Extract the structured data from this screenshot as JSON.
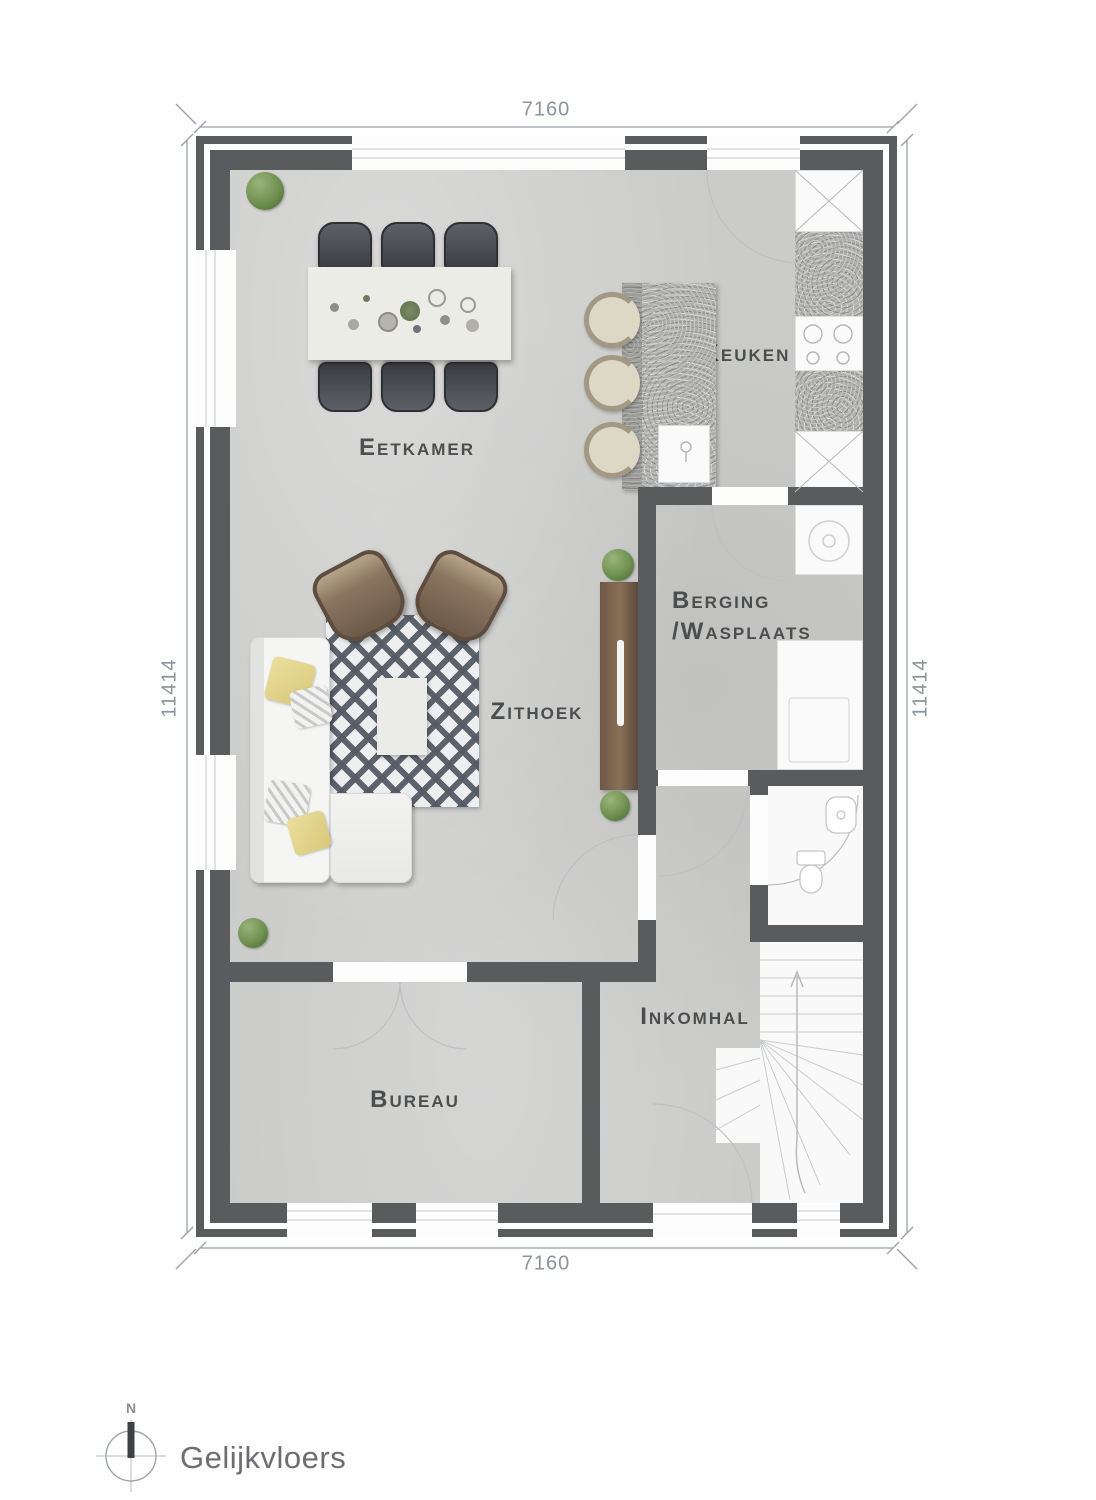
{
  "floor": {
    "title": "Gelijkvloers",
    "compass_north": "N"
  },
  "dimensions": {
    "top": "7160",
    "bottom": "7160",
    "left": "11414",
    "right": "11414"
  },
  "rooms": {
    "eetkamer": "Eetkamer",
    "keuken": "Keuken",
    "berging_line1": "Berging",
    "berging_line2": "/Wasplaats",
    "zithoek": "Zithoek",
    "inkomhal": "Inkomhal",
    "bureau": "Bureau"
  },
  "colors": {
    "wall": "#5a5b5d",
    "floor": "#cbcbca",
    "room_label": "#4b4d4f",
    "dimension_text": "#8e939b",
    "plant_green": "#6f9150",
    "rug_pattern": "#555b65",
    "wood_brown": "#6e5847",
    "title_text": "#6d6e71"
  }
}
